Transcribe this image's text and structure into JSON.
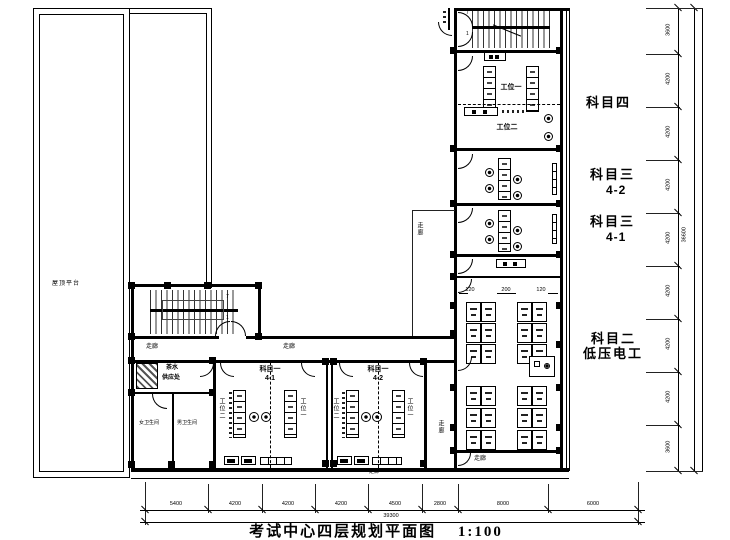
{
  "title": {
    "text": "考试中心四层规划平面图",
    "scale": "1:100"
  },
  "labels": {
    "roof_terrace": "屋顶平台",
    "corridor": "走廊",
    "subject4": "科目四",
    "subject3": "科目三",
    "sub_42": "4-2",
    "sub_41": "4-1",
    "subject2": "科目二",
    "subject2_sub": "低压电工",
    "subject1": "科目一",
    "workstation1": "工位一",
    "workstation2": "工位二",
    "tea1": "茶水",
    "tea2": "供应处",
    "toilet_women": "女卫生间",
    "toilet_men": "男卫生间",
    "stair_top": "7",
    "stair_bottom": "1"
  },
  "dimensions": {
    "bottom_segments": [
      "5400",
      "4200",
      "4200",
      "4200",
      "4500",
      "2800",
      "8000",
      "6000"
    ],
    "bottom_total": "39300",
    "right_segments": [
      "3600",
      "4200",
      "4200",
      "4200",
      "4200",
      "4200",
      "4200",
      "4200",
      "3600"
    ],
    "right_total": "36600",
    "detail": [
      "120",
      "200",
      "120"
    ]
  }
}
